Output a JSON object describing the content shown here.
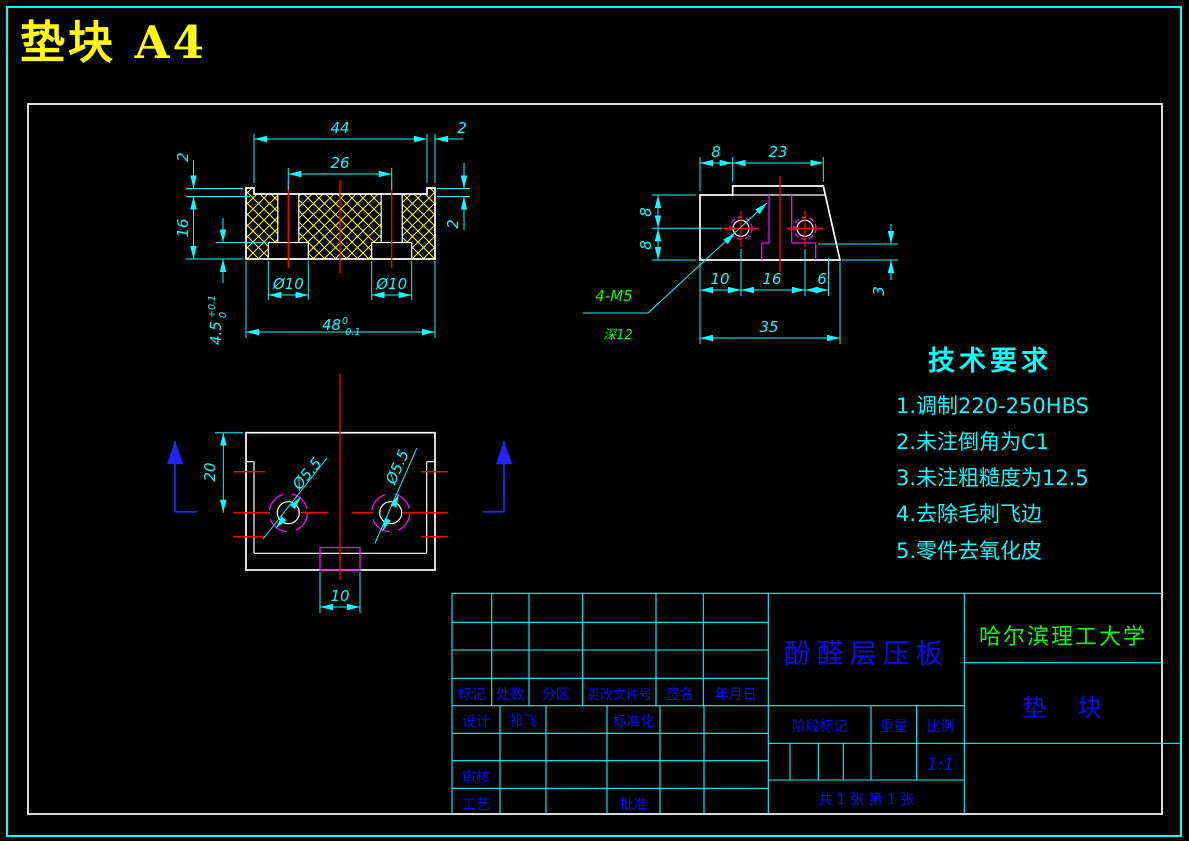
{
  "window": {
    "title": "垫块 A4"
  },
  "colors": {
    "background": "#000000",
    "frame_outer": "#00ffff",
    "frame_inner": "#ffffff",
    "outline": "#ffffff",
    "dimension": "#00ffff",
    "centerline": "#ff0000",
    "hidden_feature": "#ff00ff",
    "hatch": "#ffff00",
    "annotation_green": "#00ff00",
    "title_block_text": "#0000ff",
    "sheet_title": "#ffff00",
    "section_arrow": "#0000ff"
  },
  "tech": {
    "title": "技术要求",
    "items": [
      "1.调制220-250HBS",
      "2.未注倒角为C1",
      "3.未注粗糙度为12.5",
      "4.去除毛刺飞边",
      "5.零件去氧化皮"
    ]
  },
  "views": {
    "front": {
      "dims": {
        "w44": "44",
        "t2": "2",
        "s26": "26",
        "l2": "2",
        "h16": "16",
        "r2": "2",
        "cb1": "Ø10",
        "cb2": "Ø10",
        "w48": "48",
        "w48u": "0",
        "w48l": "-0.1",
        "d45": "4.5",
        "d45u": "+0.1",
        "d45l": "0"
      }
    },
    "side": {
      "dims": {
        "o8": "8",
        "t23": "23",
        "u8": "8",
        "l8": "8",
        "b10": "10",
        "b16": "16",
        "b6": "6",
        "r3": "3",
        "w35": "35"
      },
      "leader1": "4-M5",
      "leader2": "深12"
    },
    "plan": {
      "dims": {
        "v20": "20",
        "n10": "10",
        "h1": "Ø5.5",
        "h2": "Ø5.5"
      }
    }
  },
  "tb": {
    "material": "酚醛层压板",
    "university": "哈尔滨理工大学",
    "part_name": "垫 块",
    "header": [
      "标记",
      "处数",
      "分区",
      "更改文件号",
      "签名",
      "年月日"
    ],
    "design": "设计",
    "designer": "祁飞",
    "standardization": "标准化",
    "review": "审核",
    "process": "工艺",
    "approve": "批准",
    "stage": "阶段标记",
    "weight": "重量",
    "scale": "比例",
    "scale_value": "1:1",
    "sheet": "共 1 张  第 1 张"
  }
}
